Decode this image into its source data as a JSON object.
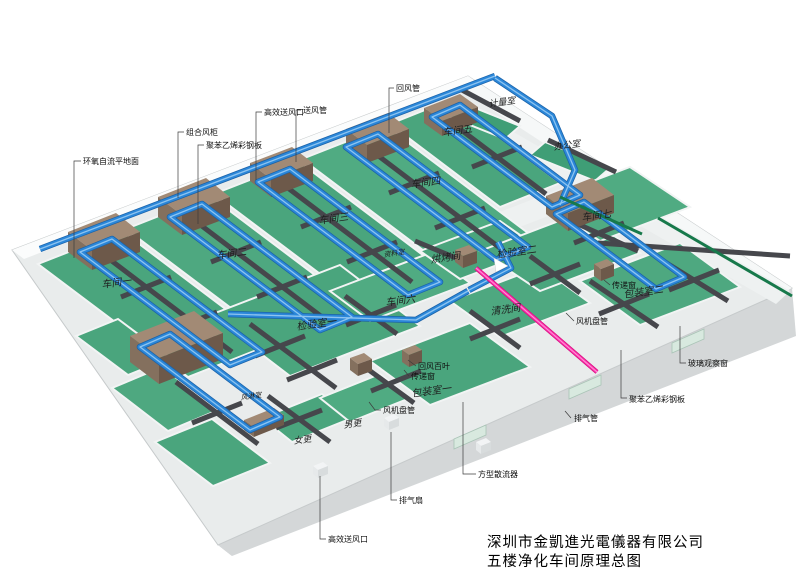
{
  "title": {
    "line1": "深圳市金凱進光電儀器有限公司",
    "line2": "五楼净化车间原理总图"
  },
  "colors": {
    "floor_green": "#4aa57d",
    "duct_blue": "#2b87d9",
    "duct_dark": "#46474c",
    "ahu_brown_top": "#a28a75",
    "ahu_brown_front": "#6d594a",
    "exhaust_pink": "#ff2fae",
    "conveyor_green": "#17794b",
    "slab_gray": "#d4d7d8",
    "wall_light": "#e9ecec"
  },
  "room_labels": [
    {
      "id": "workshop-1",
      "text": "车间一",
      "x": 102,
      "y": 288,
      "size": 10
    },
    {
      "id": "workshop-2",
      "text": "车间二",
      "x": 217,
      "y": 259,
      "size": 10
    },
    {
      "id": "workshop-3",
      "text": "车间三",
      "x": 319,
      "y": 224,
      "size": 10
    },
    {
      "id": "workshop-4",
      "text": "车间四",
      "x": 411,
      "y": 188,
      "size": 10
    },
    {
      "id": "workshop-5",
      "text": "车间五",
      "x": 443,
      "y": 136,
      "size": 10
    },
    {
      "id": "workshop-6",
      "text": "车间六",
      "x": 386,
      "y": 306,
      "size": 10
    },
    {
      "id": "workshop-7",
      "text": "车间七",
      "x": 582,
      "y": 221,
      "size": 10
    },
    {
      "id": "inspection-room-1",
      "text": "检验室一",
      "x": 297,
      "y": 330,
      "size": 10
    },
    {
      "id": "inspection-room-2",
      "text": "检验室二",
      "x": 497,
      "y": 258,
      "size": 10
    },
    {
      "id": "packing-room-1",
      "text": "包装室一",
      "x": 412,
      "y": 397,
      "size": 10
    },
    {
      "id": "packing-room-2",
      "text": "包装室二",
      "x": 624,
      "y": 298,
      "size": 10
    },
    {
      "id": "baking-room",
      "text": "烘烤间",
      "x": 431,
      "y": 263,
      "size": 10
    },
    {
      "id": "cleaning-room",
      "text": "清洗间",
      "x": 491,
      "y": 315,
      "size": 10
    },
    {
      "id": "data-room",
      "text": "资料室",
      "x": 384,
      "y": 257,
      "size": 7
    },
    {
      "id": "air-shower-room",
      "text": "风淋室",
      "x": 241,
      "y": 400,
      "size": 7
    },
    {
      "id": "men-changing-room",
      "text": "男更",
      "x": 344,
      "y": 428,
      "size": 9
    },
    {
      "id": "women-changing-room",
      "text": "女更",
      "x": 294,
      "y": 444,
      "size": 9
    },
    {
      "id": "metrology-room",
      "text": "计量室",
      "x": 489,
      "y": 107,
      "size": 9
    },
    {
      "id": "office",
      "text": "办公室",
      "x": 554,
      "y": 150,
      "size": 9
    }
  ],
  "callouts": [
    {
      "id": "epoxy-floor",
      "text": "环氧自流平地面",
      "x": 83,
      "y": 164,
      "leader": [
        [
          81,
          161
        ],
        [
          74,
          161
        ],
        [
          74,
          258
        ]
      ]
    },
    {
      "id": "combined-air-cabinet",
      "text": "组合风柜",
      "x": 186,
      "y": 135,
      "leader": [
        [
          184,
          132
        ],
        [
          178,
          132
        ],
        [
          178,
          198
        ]
      ]
    },
    {
      "id": "polystyrene-panel-top",
      "text": "聚苯乙烯彩钢板",
      "x": 206,
      "y": 148,
      "leader": [
        [
          204,
          145
        ],
        [
          198,
          145
        ],
        [
          198,
          224
        ]
      ]
    },
    {
      "id": "hepa-outlet-top",
      "text": "高效送风口",
      "x": 264,
      "y": 115,
      "leader": [
        [
          262,
          112
        ],
        [
          256,
          112
        ],
        [
          256,
          180
        ]
      ]
    },
    {
      "id": "supply-duct",
      "text": "送风管",
      "x": 303,
      "y": 113,
      "leader": [
        [
          301,
          110
        ],
        [
          296,
          110
        ],
        [
          296,
          162
        ]
      ]
    },
    {
      "id": "return-duct",
      "text": "回风管",
      "x": 396,
      "y": 91,
      "leader": [
        [
          394,
          88
        ],
        [
          389,
          88
        ],
        [
          389,
          133
        ]
      ]
    },
    {
      "id": "exhaust-fan",
      "text": "排气扇",
      "x": 399,
      "y": 503,
      "leader": [
        [
          397,
          500
        ],
        [
          391,
          500
        ],
        [
          391,
          432
        ]
      ]
    },
    {
      "id": "square-diffuser",
      "text": "方型散流器",
      "x": 478,
      "y": 477,
      "leader": [
        [
          476,
          474
        ],
        [
          463,
          474
        ],
        [
          463,
          402
        ]
      ]
    },
    {
      "id": "hepa-outlet-bottom",
      "text": "高效送风口",
      "x": 328,
      "y": 542,
      "leader": [
        [
          326,
          539
        ],
        [
          320,
          539
        ],
        [
          320,
          476
        ]
      ]
    },
    {
      "id": "exhaust-duct",
      "text": "排气管",
      "x": 574,
      "y": 421,
      "leader": [
        [
          571,
          418
        ],
        [
          565,
          411
        ]
      ]
    },
    {
      "id": "glass-observation-window",
      "text": "玻璃观察窗",
      "x": 688,
      "y": 366,
      "leader": [
        [
          686,
          363
        ],
        [
          680,
          363
        ],
        [
          680,
          326
        ]
      ]
    },
    {
      "id": "polystyrene-panel-right",
      "text": "聚苯乙烯彩钢板",
      "x": 629,
      "y": 402,
      "leader": [
        [
          627,
          398
        ],
        [
          621,
          398
        ],
        [
          621,
          350
        ]
      ]
    },
    {
      "id": "fan-coil-right",
      "text": "风机盘管",
      "x": 576,
      "y": 324,
      "leader": [
        [
          574,
          321
        ],
        [
          566,
          313
        ]
      ]
    },
    {
      "id": "fan-coil-bottom",
      "text": "风机盘管",
      "x": 383,
      "y": 413,
      "leader": [
        [
          381,
          410
        ],
        [
          375,
          410
        ],
        [
          369,
          402
        ]
      ]
    },
    {
      "id": "return-air-louver",
      "text": "回风百叶",
      "x": 418,
      "y": 369,
      "leader": [
        [
          416,
          366
        ],
        [
          408,
          360
        ]
      ]
    },
    {
      "id": "pass-through-window-1",
      "text": "传递窗",
      "x": 411,
      "y": 379,
      "leader": [
        [
          409,
          376
        ],
        [
          404,
          370
        ]
      ]
    },
    {
      "id": "pass-through-window-2",
      "text": "传递窗",
      "x": 612,
      "y": 288,
      "leader": [
        [
          610,
          285
        ],
        [
          604,
          280
        ]
      ]
    }
  ]
}
